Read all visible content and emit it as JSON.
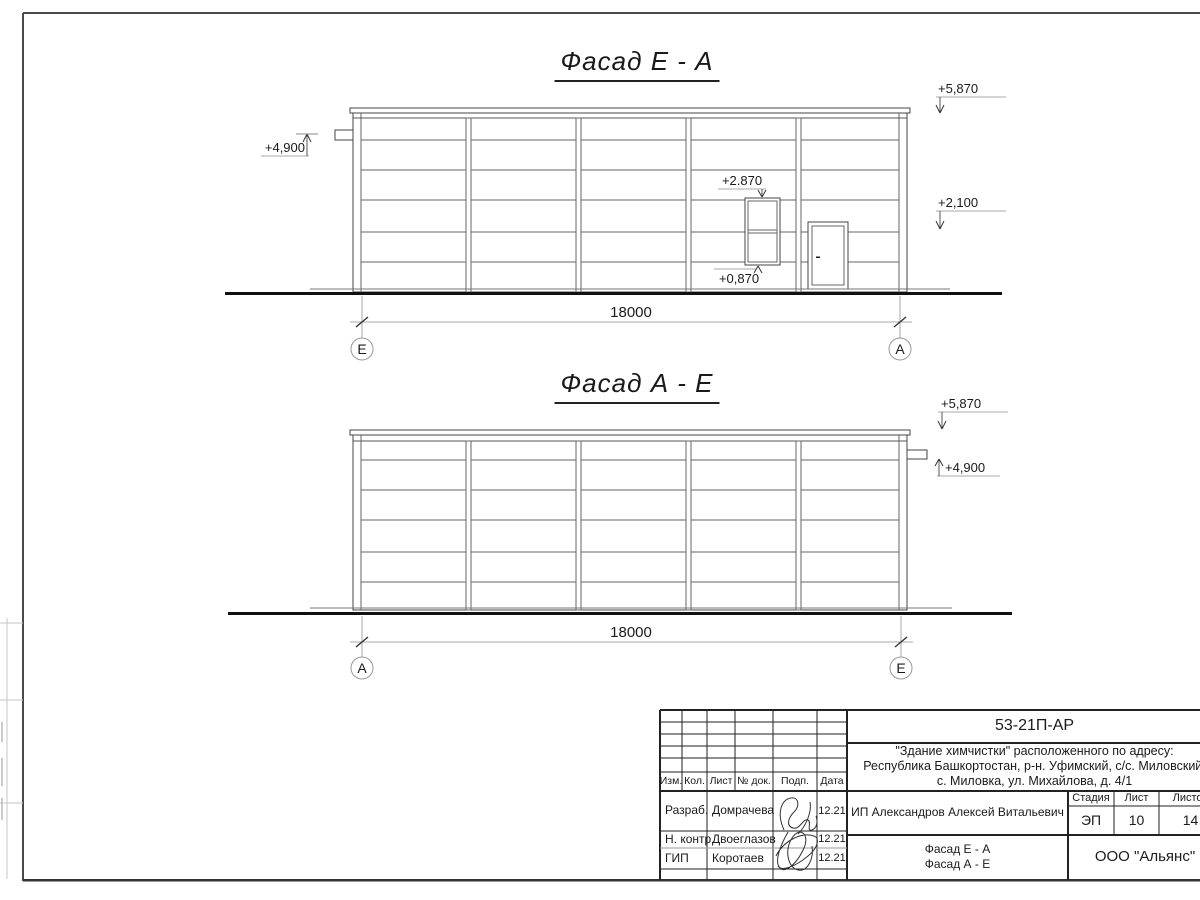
{
  "sheet": {
    "views": [
      {
        "title": "Фасад Е - А",
        "dimension": "18000",
        "axis_left": "Е",
        "axis_right": "А",
        "marks": {
          "left_crane": "+4,900",
          "parapet": "+5,870",
          "door_top": "+2,100",
          "window_top": "+2.870",
          "window_sill": "+0,870"
        }
      },
      {
        "title": "Фасад А - Е",
        "dimension": "18000",
        "axis_left": "А",
        "axis_right": "Е",
        "marks": {
          "parapet": "+5,870",
          "right_crane": "+4,900"
        }
      }
    ]
  },
  "title_block": {
    "doc_number": "53-21П-АР",
    "project_lines": [
      "\"Здание химчистки\" расположенного по адресу:",
      "Республика Башкортостан, р-н. Уфимский, с/с. Миловский,",
      "с. Миловка, ул. Михайлова, д. 4/1"
    ],
    "rev_headers": [
      "Изм.",
      "Кол.",
      "Лист",
      "№ док.",
      "Подп.",
      "Дата"
    ],
    "staff": [
      {
        "role": "Разраб.",
        "name": "Домрачева",
        "date": "12.21"
      },
      {
        "role": "Н. контр.",
        "name": "Двоеглазов",
        "date": "12.21"
      },
      {
        "role": "ГИП",
        "name": "Коротаев",
        "date": "12.21"
      }
    ],
    "client": "ИП Александров Алексей Витальевич",
    "stage_label": "Стадия",
    "sheet_label": "Лист",
    "sheets_label": "Листов",
    "stage": "ЭП",
    "sheet_no": "10",
    "sheets_total": "14",
    "content": [
      "Фасад Е - А",
      "Фасад А - Е"
    ],
    "organization": "ООО \"Альянс\""
  }
}
